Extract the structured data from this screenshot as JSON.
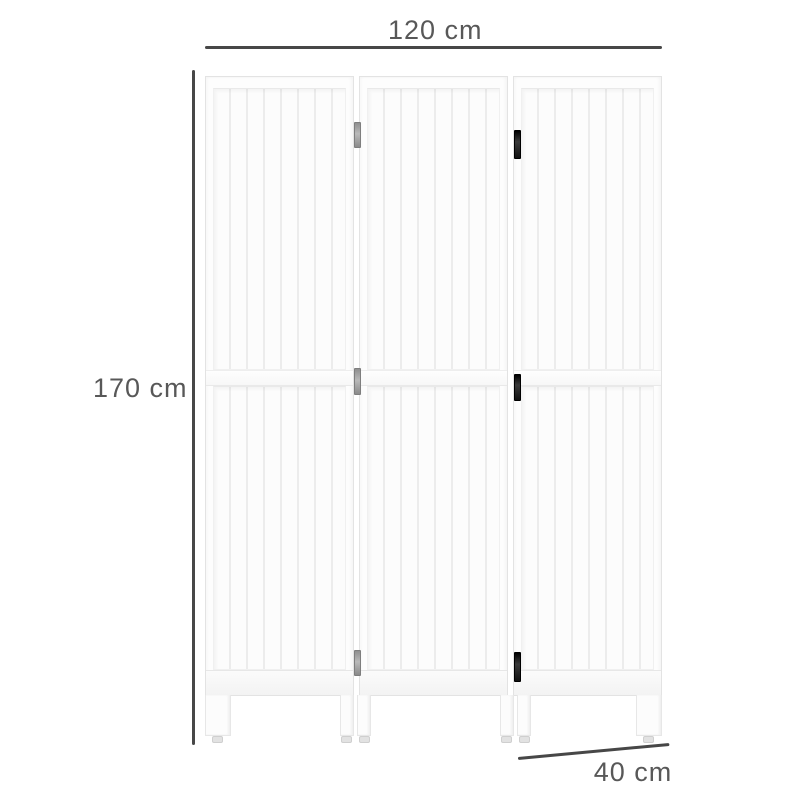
{
  "product": {
    "name": "3-panel wooden folding room divider, white slatted panels",
    "panel_count": 3
  },
  "dimensions": {
    "width": {
      "label": "120 cm",
      "orientation": "horizontal-top"
    },
    "height": {
      "label": "170 cm",
      "orientation": "vertical-left"
    },
    "depth": {
      "label": "40 cm",
      "orientation": "diagonal-bottom-right"
    }
  },
  "colors": {
    "dimension_line": "#474747",
    "label_text": "#585858",
    "panel_fill": "#fdfdfd",
    "panel_border": "#e3e3e3",
    "groove": "#ececec",
    "hinge_dark": "#1c1c1c",
    "hinge_silver": "#a6a6a6",
    "background": "#ffffff"
  }
}
